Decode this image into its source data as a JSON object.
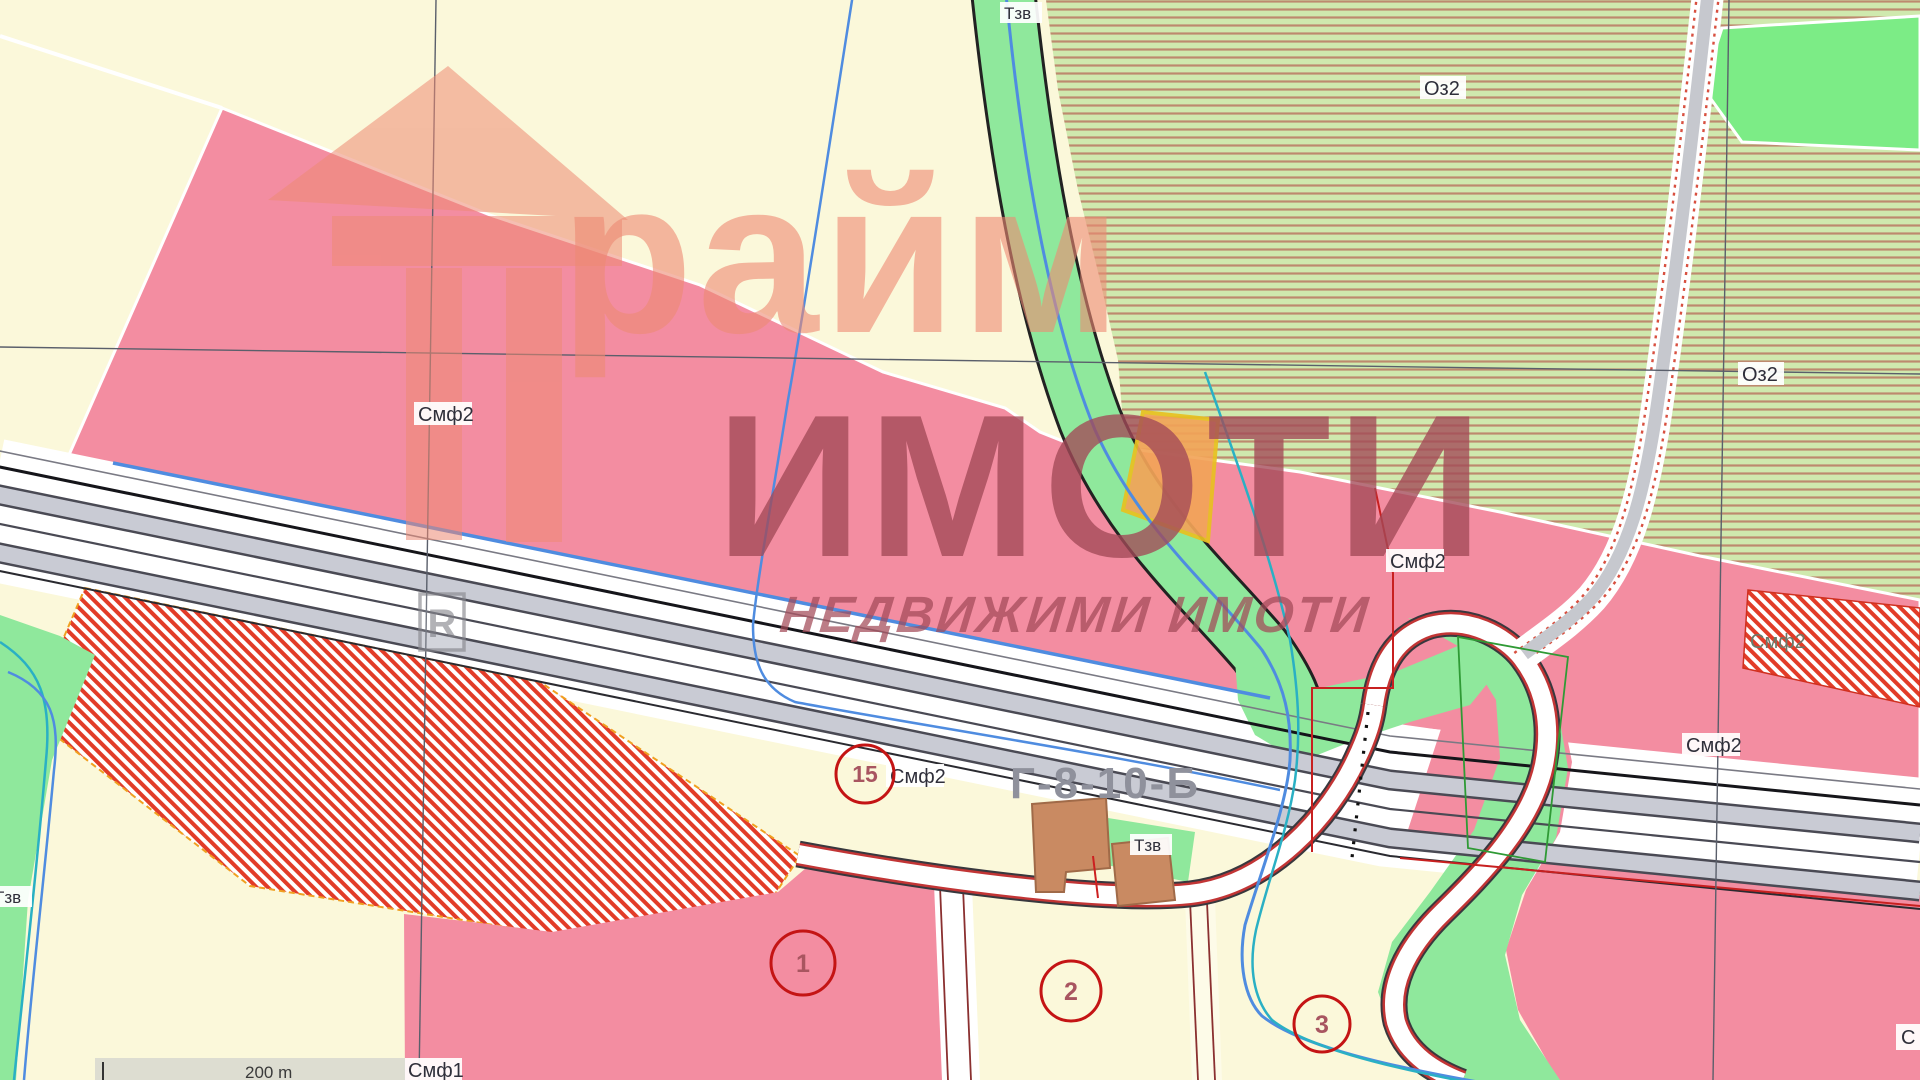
{
  "map": {
    "title": "Urban zoning plan extract (cadastral map)",
    "labels": {
      "tzv1": "Тзв",
      "tzv2": "Тзв",
      "tzv3": "Тзв",
      "oz2_a": "Оз2",
      "oz2_b": "Оз2",
      "smf2_a": "Смф2",
      "smf2_b": "Смф2",
      "smf2_c": "Смф2",
      "smf2_d": "Смф2",
      "smf2_e": "Смф2",
      "smf1": "Смф1",
      "partial_right": "С",
      "road_code": "Г-8-10-Б"
    },
    "parcel_numbers": {
      "c15": "15",
      "c1": "1",
      "c2": "2",
      "c3": "3"
    },
    "scale": {
      "text": "200 m"
    },
    "watermark": {
      "brand_top": "райм",
      "brand_main": "ИМОТИ",
      "brand_sub": "НЕДВИЖИМИ ИМОТИ",
      "registered_mark": "R"
    },
    "colors": {
      "zone_mixed_pink": "#f38da1",
      "zone_background_cream": "#fbf8da",
      "greenery": "#8fe89c",
      "oz2_hatch_stripe": "#bd8a6e",
      "oz2_hatch_bg": "#cfe9ae",
      "red_hatch": "#e23c28",
      "road_gray": "#c9cbd4",
      "water_blue": "#4f8ce0",
      "water_teal": "#2ab0c4",
      "boundary_red": "#c82020",
      "watermark_salmon": "#ee8a74",
      "watermark_maroon": "#a34a58"
    }
  }
}
